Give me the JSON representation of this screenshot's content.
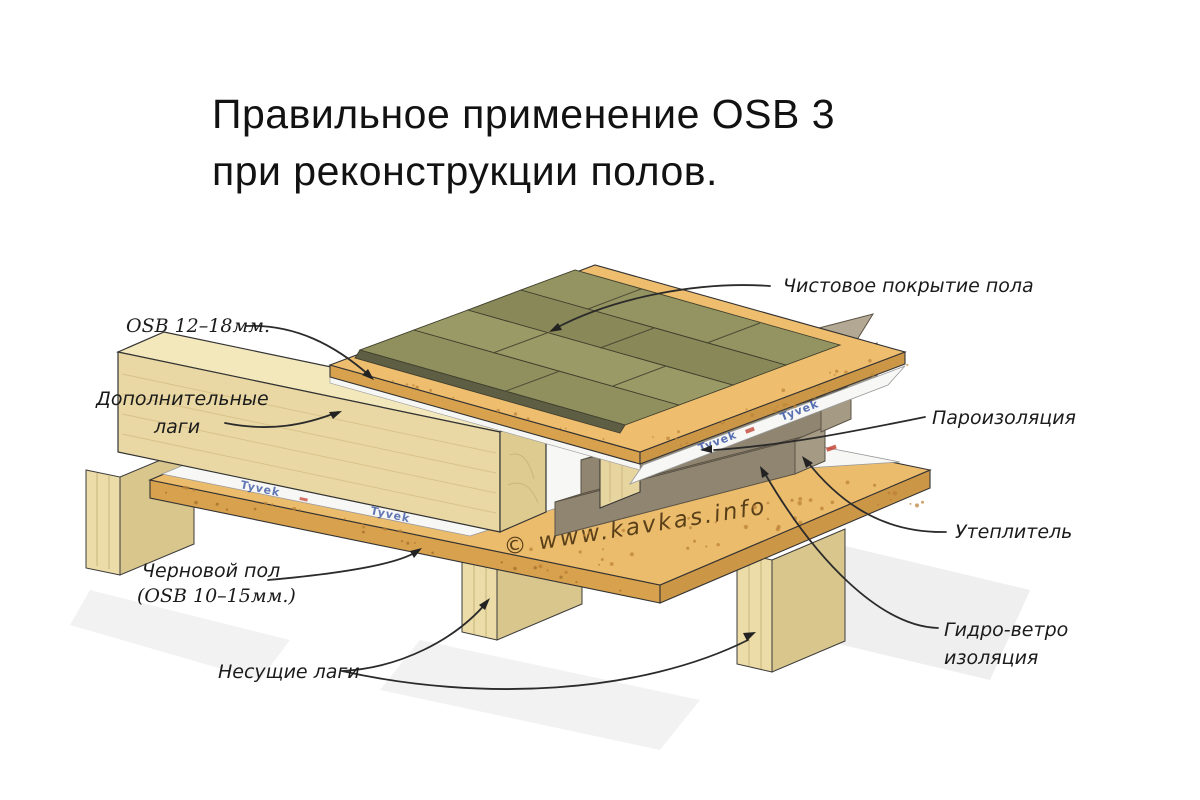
{
  "title": {
    "line1": "Правильное применение OSB 3",
    "line2": "при реконструкции полов."
  },
  "callouts": {
    "finish_floor": "Чистовое покрытие пола",
    "osb_top": "OSB 12–18мм.",
    "additional_joists": "Дополнительные\nлаги",
    "vapor_barrier": "Пароизоляция",
    "insulation": "Утеплитель",
    "hydro_wind": "Гидро-ветро\nизоляция",
    "subfloor": "Черновой пол",
    "subfloor_spec": "(OSB 10–15мм.)",
    "bearing_joists": "Несущие лаги"
  },
  "diagram": {
    "membrane_brand": "Tyvek",
    "watermark": "© www.kavkas.info",
    "colors": {
      "osb": "#ecbc6d",
      "osb_edge": "#d8a14e",
      "wood": "#e9d8a4",
      "insulation": "#b7ad99",
      "membrane": "#f7f7f5",
      "tyvek_blue": "#24439b",
      "accent_red": "#c0392b",
      "plank_olive": "#90905e"
    }
  }
}
